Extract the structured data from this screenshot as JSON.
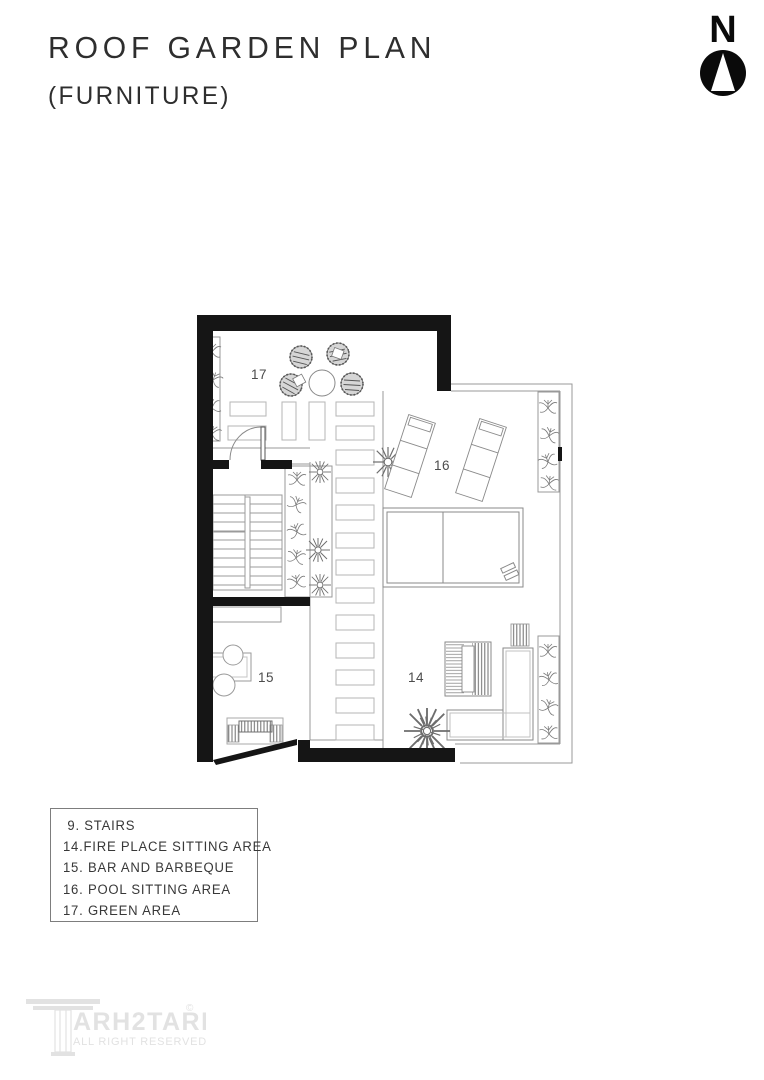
{
  "header": {
    "title": "ROOF GARDEN PLAN",
    "subtitle": "(FURNITURE)"
  },
  "north_label": "N",
  "plan": {
    "labels": {
      "a14": "14",
      "a15": "15",
      "a16": "16",
      "a17": "17"
    }
  },
  "legend": {
    "items": [
      " 9. STAIRS",
      "14.FIRE PLACE SITTING AREA",
      "15. BAR AND BARBEQUE",
      "16. POOL SITTING AREA",
      "17. GREEN AREA"
    ]
  },
  "logo": {
    "brand": "ARH2TARH",
    "mark": "©",
    "tagline": "ALL RIGHT RESERVED"
  },
  "colors": {
    "wall": "#151515",
    "thin_line": "#999999",
    "paver_line": "#b5b5b5",
    "label_text": "#4c4c4c",
    "title_text": "#2e2e2e",
    "logo_gray": "#e2e2e2"
  }
}
